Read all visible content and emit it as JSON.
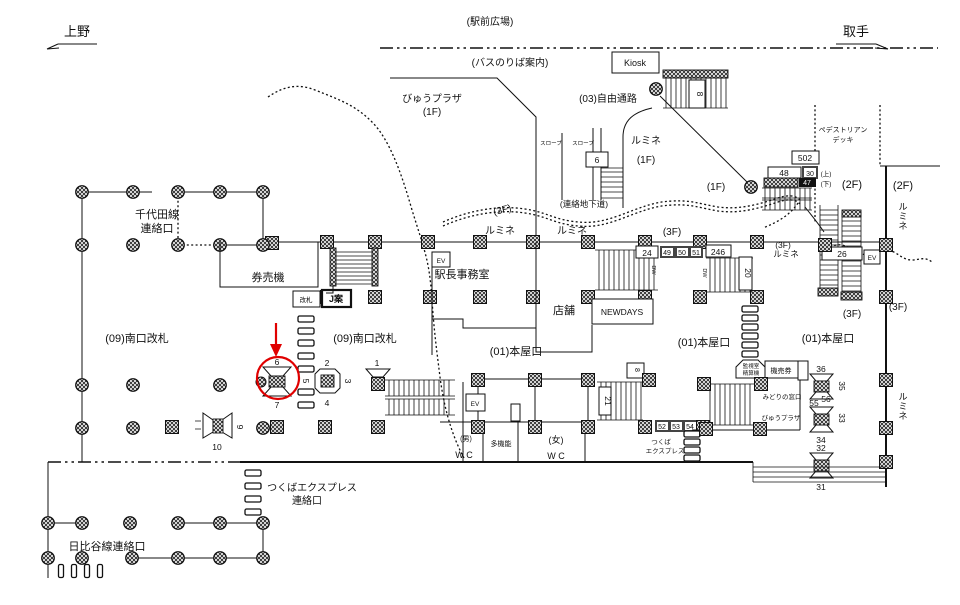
{
  "colors": {
    "ink": "#111111",
    "red": "#e00000",
    "bg": "#ffffff"
  },
  "labels": {
    "ueno": "上野",
    "toride": "取手",
    "ekimae": "(駅前広場)",
    "bus": "(バスのりば案内)",
    "kiosk": "Kiosk",
    "viewplaza1a": "びゅうプラザ",
    "viewplaza1b": "(1F)",
    "jiyu": "(03)自由通路",
    "lumine1a": "ルミネ",
    "lumine1b": "(1F)",
    "f1mid": "(1F)",
    "slope1": "スロープ",
    "slope2": "スロープ",
    "chikado": "(連絡地下道)",
    "ped1": "ペデストリアン",
    "ped2": "デッキ",
    "f2a": "(2F)",
    "f2b": "(2F)",
    "lumineVT": "ルミネ",
    "lumineVB": "ルミネ",
    "f3curve": "(3F)",
    "f3mid": "(3F)",
    "f3lumine": "(3F)",
    "lumineC": "ルミネ",
    "f3esc": "(3F)",
    "f3wall": "(3F)",
    "jou": "(上)",
    "ge": "(下)",
    "chiyoda1": "千代田線",
    "chiyoda2": "連絡口",
    "kenbaiki": "券売機",
    "kaisatsu": "改札",
    "jan": "J案",
    "minamiL": "(09)南口改札",
    "minamiR": "(09)南口改札",
    "lumineA": "ルミネ",
    "lumineB": "ルミネ",
    "ekicho": "駅長事務室",
    "tenpo": "店舗",
    "newdays": "NEWDAYS",
    "ev": "EV",
    "dw": "DW",
    "honyaL": "(01)本屋口",
    "honyaM": "(01)本屋口",
    "honyaR": "(01)本屋口",
    "kanshi1": "監視室",
    "kanshi2": "精算機",
    "kenbaiki2": "機売券",
    "midori": "みどりの窓口",
    "viewplaza2": "びゅうプラザ",
    "male": "(男)",
    "maleWC": "W C",
    "takinou": "多機能",
    "female": "(女)",
    "femaleWC": "W C",
    "tsukuba1": "つくば",
    "tsukuba2": "エクスプレス",
    "tsukubaR1": "つくばエクスプレス",
    "tsukubaR2": "連絡口",
    "hibiya": "日比谷線連絡口"
  },
  "nums": {
    "n1": "1",
    "n2": "2",
    "n3": "3",
    "n4": "4",
    "n5": "5",
    "n6": "6",
    "n7": "7",
    "n8a": "8",
    "n8b": "8",
    "n9": "9",
    "n10": "10",
    "n20": "20",
    "n21": "21",
    "n24": "24",
    "n26": "26",
    "n30": "30",
    "n31": "31",
    "n32": "32",
    "n33": "33",
    "n34": "34",
    "n35": "35",
    "n36": "36",
    "n47": "47",
    "n48": "48",
    "n49": "49",
    "n50": "50",
    "n51": "51",
    "n52": "52",
    "n53": "53",
    "n54": "54",
    "n55": "55",
    "n56": "56",
    "n246": "246",
    "n502": "502",
    "slope6": "6"
  }
}
